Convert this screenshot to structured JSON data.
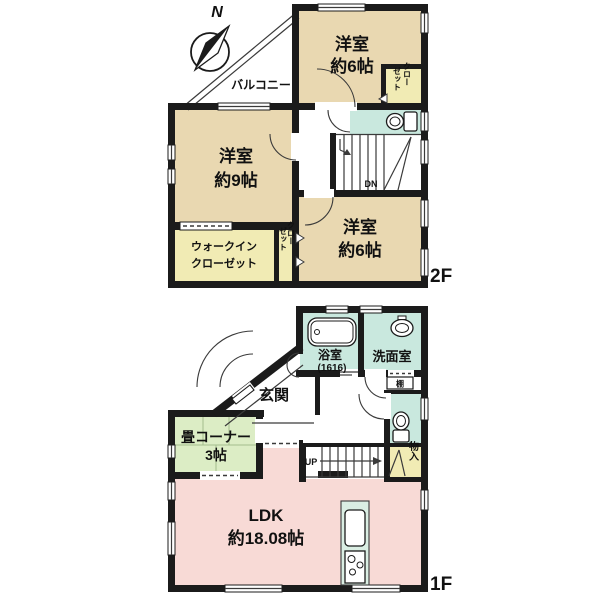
{
  "compass": {
    "north": "N"
  },
  "floor2": {
    "label": "2F",
    "balcony": "バルコニー",
    "room_top": {
      "name": "洋室",
      "size": "約6帖"
    },
    "room_left": {
      "name": "洋室",
      "size": "約9帖"
    },
    "room_bottom": {
      "name": "洋室",
      "size": "約6帖"
    },
    "wic": {
      "line1": "ウォークイン",
      "line2": "クローゼット"
    },
    "closet_top": {
      "col1": "クロー",
      "col2": "ゼット"
    },
    "closet_mid": {
      "col1": "クロー",
      "col2": "ゼット"
    },
    "stairs": "DN"
  },
  "floor1": {
    "label": "1F",
    "entrance": "玄関",
    "bath": {
      "name": "浴室",
      "size": "(1616)"
    },
    "washroom": "洗面室",
    "shelf": "棚",
    "storage": "物入",
    "tatami": {
      "line1": "畳コーナー",
      "line2": "3帖"
    },
    "ldk": {
      "name": "LDK",
      "size": "約18.08帖"
    },
    "stairs": "UP"
  },
  "colors": {
    "wall": "#1b1b1b",
    "western_room": "#e9d8b1",
    "closet": "#f1ebb4",
    "tatami": "#dcedc5",
    "ldk": "#f8dad6",
    "wet_area": "#c9e8de",
    "kitchen_counter": "#daeee3"
  }
}
